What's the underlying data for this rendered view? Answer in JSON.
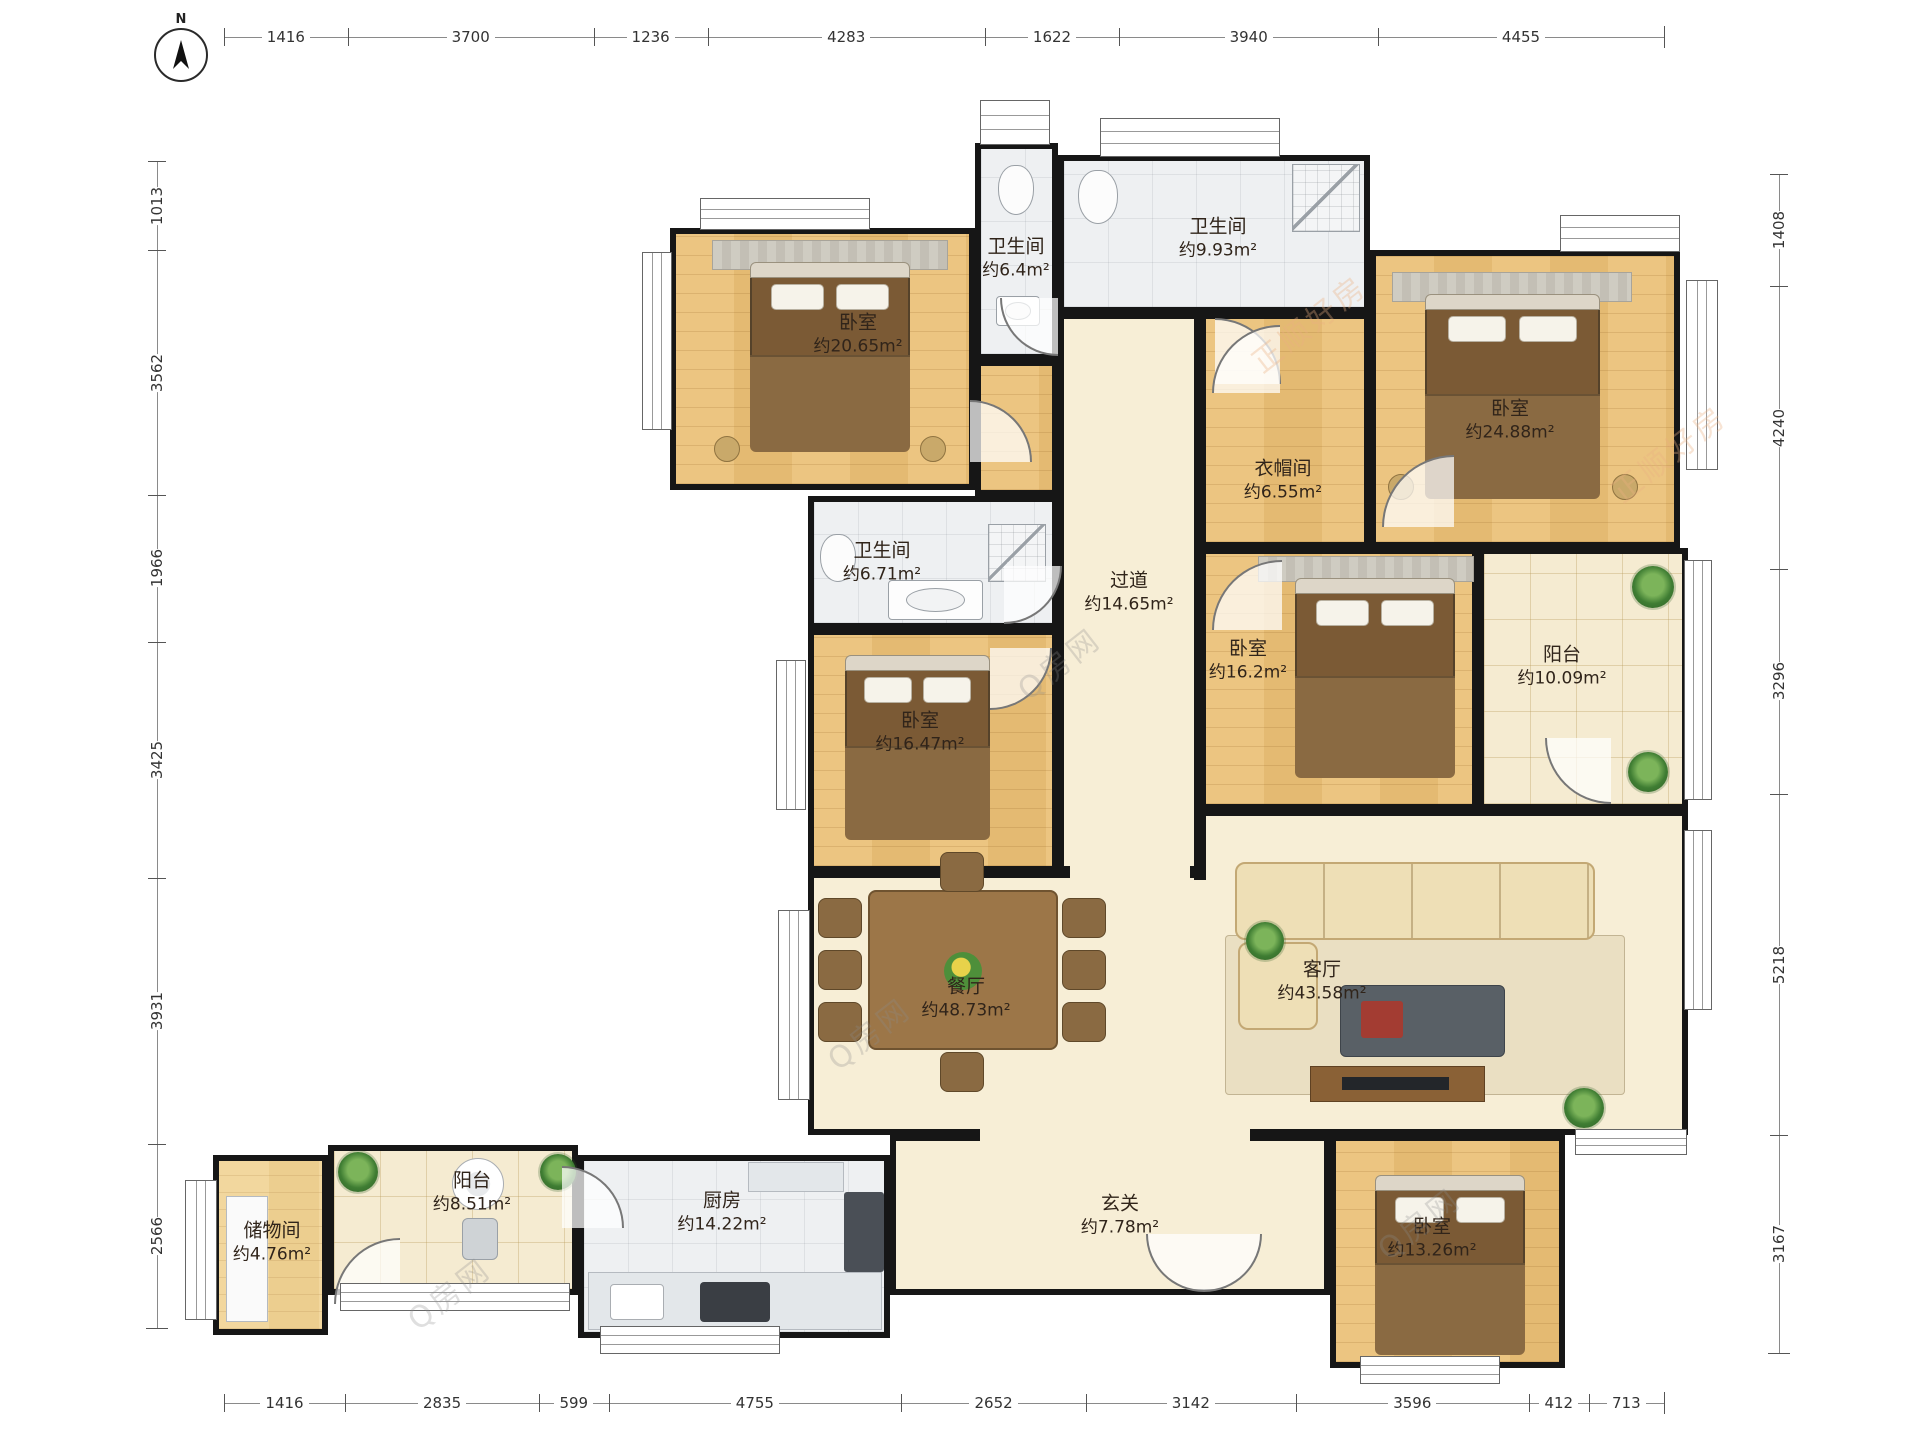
{
  "compass": {
    "label": "N"
  },
  "rulers": {
    "top": [
      "1416",
      "3700",
      "1236",
      "4283",
      "1622",
      "3940",
      "4455"
    ],
    "bottom": [
      "1416",
      "2835",
      "599",
      "4755",
      "2652",
      "3142",
      "3596",
      "412",
      "713"
    ],
    "left": [
      "1013",
      "3562",
      "1966",
      "3425",
      "3931",
      "2566"
    ],
    "right": [
      "1408",
      "4240",
      "3296",
      "5218",
      "3167"
    ]
  },
  "rooms": [
    {
      "id": "bedroom-top-left",
      "name": "卧室",
      "area": "约20.65m²"
    },
    {
      "id": "bathroom-top-small",
      "name": "卫生间",
      "area": "约6.4m²"
    },
    {
      "id": "bathroom-top",
      "name": "卫生间",
      "area": "约9.93m²"
    },
    {
      "id": "bedroom-top-right",
      "name": "卧室",
      "area": "约24.88m²"
    },
    {
      "id": "closet",
      "name": "衣帽间",
      "area": "约6.55m²"
    },
    {
      "id": "hallway",
      "name": "过道",
      "area": "约14.65m²"
    },
    {
      "id": "bathroom-middle",
      "name": "卫生间",
      "area": "约6.71m²"
    },
    {
      "id": "bedroom-middle-left",
      "name": "卧室",
      "area": "约16.47m²"
    },
    {
      "id": "bedroom-middle-right",
      "name": "卧室",
      "area": "约16.2m²"
    },
    {
      "id": "balcony-right",
      "name": "阳台",
      "area": "约10.09m²"
    },
    {
      "id": "dining-room",
      "name": "餐厅",
      "area": "约48.73m²"
    },
    {
      "id": "living-room",
      "name": "客厅",
      "area": "约43.58m²"
    },
    {
      "id": "entry",
      "name": "玄关",
      "area": "约7.78m²"
    },
    {
      "id": "bedroom-bottom",
      "name": "卧室",
      "area": "约13.26m²"
    },
    {
      "id": "kitchen",
      "name": "厨房",
      "area": "约14.22m²"
    },
    {
      "id": "balcony-bottom",
      "name": "阳台",
      "area": "约8.51m²"
    },
    {
      "id": "storage",
      "name": "储物间",
      "area": "约4.76m²"
    }
  ],
  "watermark": {
    "text": "Q房网",
    "brand": "正顺好房"
  },
  "colors": {
    "wall": "#161616",
    "wood": "#e8c07a",
    "cream": "#f7eed6",
    "tile": "#eef0f2",
    "plant": "#3f7d33"
  }
}
